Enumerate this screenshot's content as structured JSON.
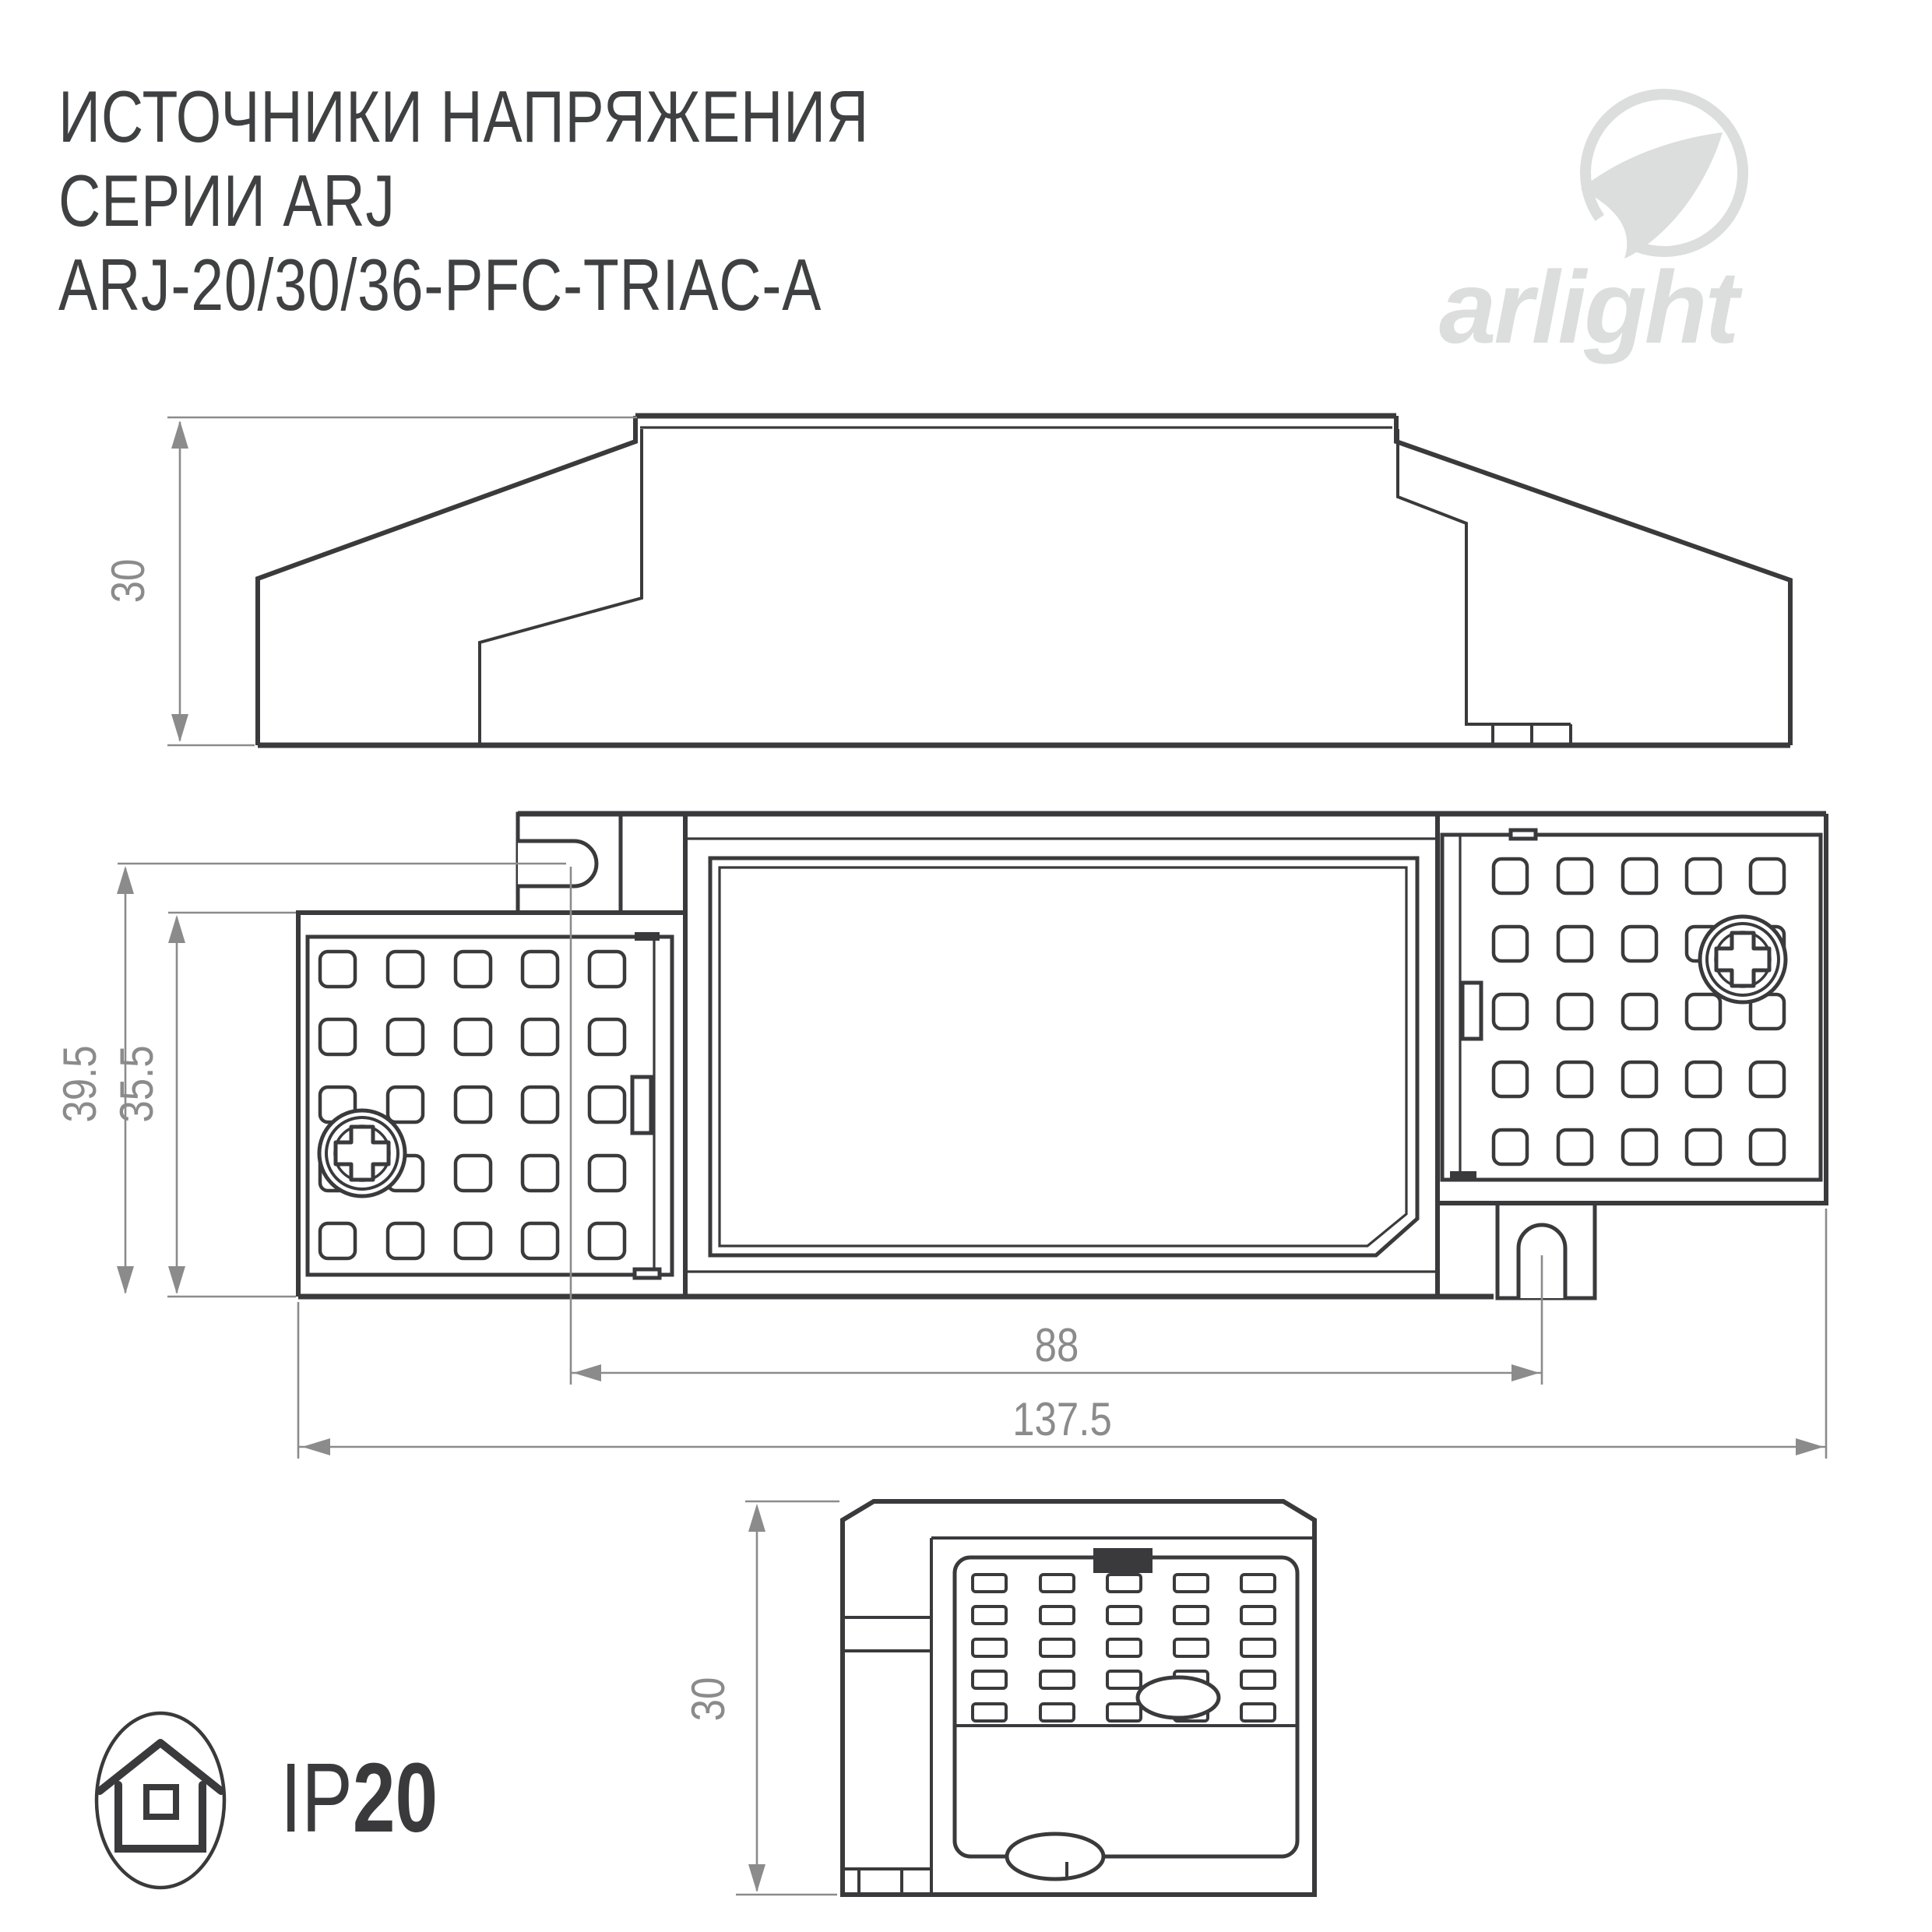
{
  "title": {
    "line1": "ИСТОЧНИКИ НАПРЯЖЕНИЯ",
    "line2": "СЕРИИ ARJ",
    "line3": "ARJ-20/30/36-PFC-TRIAC-A"
  },
  "logo": {
    "wordmark": "arlight",
    "mark": "arlight-swoosh-icon"
  },
  "dimensions": {
    "side_height": "30",
    "body_height": "39.5",
    "block_height": "35.5",
    "hole_spacing": "88",
    "overall_length": "137.5",
    "front_height": "30"
  },
  "ip_badge": {
    "icon": "house-icon",
    "prefix": "IP",
    "value": "20"
  },
  "colors": {
    "line": "#3a3a3c",
    "dimension": "#8b8b8b",
    "logo": "#dcdddd",
    "title": "#3f4041",
    "background": "#ffffff"
  }
}
